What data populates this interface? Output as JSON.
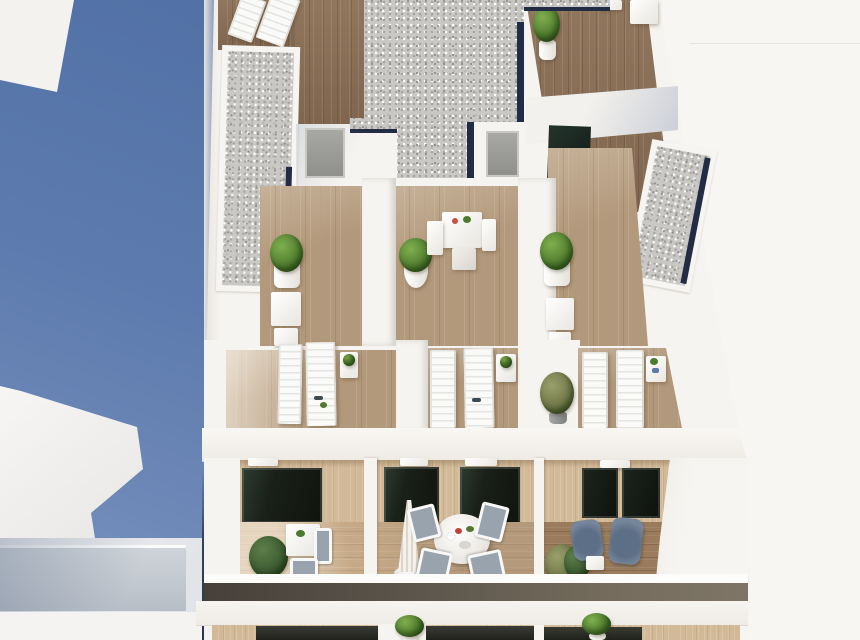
{
  "scene": {
    "type": "architectural-3d-render",
    "title": "Aerial view of a modern white apartment building with rooftop terraces and balconies",
    "view": "bird's-eye axonometric, bright daylight, blue sky reflection on the left, off-white backdrop on the right",
    "areas": [
      {
        "name": "sky-left",
        "description": "deep blue background band occupying the left side with white highlight wedges"
      },
      {
        "name": "rooftop",
        "description": "white roof volumes with gray gravel ballast fields edged in navy solar trim, dark wood roof decks, access doors"
      },
      {
        "name": "roof-terraces",
        "description": "three private wood-floored terraces with white planters, round green topiary bushes, bistro tables and chairs"
      },
      {
        "name": "lounger-terraces",
        "description": "three terraces each with two white sun loungers and a small white side table holding a green plant"
      },
      {
        "name": "balcony-level",
        "description": "wood-clad facade with dark glass sliding doors; center balcony has a round white dining table, four mesh chairs and a closed parasol; left balcony a bistro set; right balcony two blue-gray armchairs"
      },
      {
        "name": "lower-level",
        "description": "glass balustrade band, white floor slab, and a sliver of the balcony below with topiary plants in white pots"
      }
    ],
    "objects": {
      "gravel_roofs": 3,
      "sun_loungers": 8,
      "topiary_bushes": 10,
      "access_doors": 2,
      "dining_tables": 4,
      "chairs": 12,
      "armchairs": 2,
      "parasols": 1
    }
  },
  "palette": {
    "sky_top": "#5170a5",
    "sky_bottom": "#7c94c0",
    "bg_offwhite": "#f8f6f2",
    "wall_white": "#f6f4f0",
    "wall_shadow": "#e6e3dd",
    "gravel": "#c9c8c4",
    "navy_edge": "#232c45",
    "wood_dark": "#8a6e54",
    "wood_mid": "#b3997b",
    "wood_light": "#c7ab89",
    "wood_facade": "#d2ba98",
    "wood_balcony_right": "#9a7b5c",
    "dark_glass": "#161c15",
    "teal_glass": "#24352c",
    "plant_light": "#7fae4e",
    "plant_mid": "#4e7a2d",
    "plant_dark": "#2f4f1b",
    "chair_mesh": "#99a3ad",
    "armchair": "#5d6f86",
    "balustrade_glass": "#56503f",
    "shadow_blue": "#8fa0bf"
  }
}
